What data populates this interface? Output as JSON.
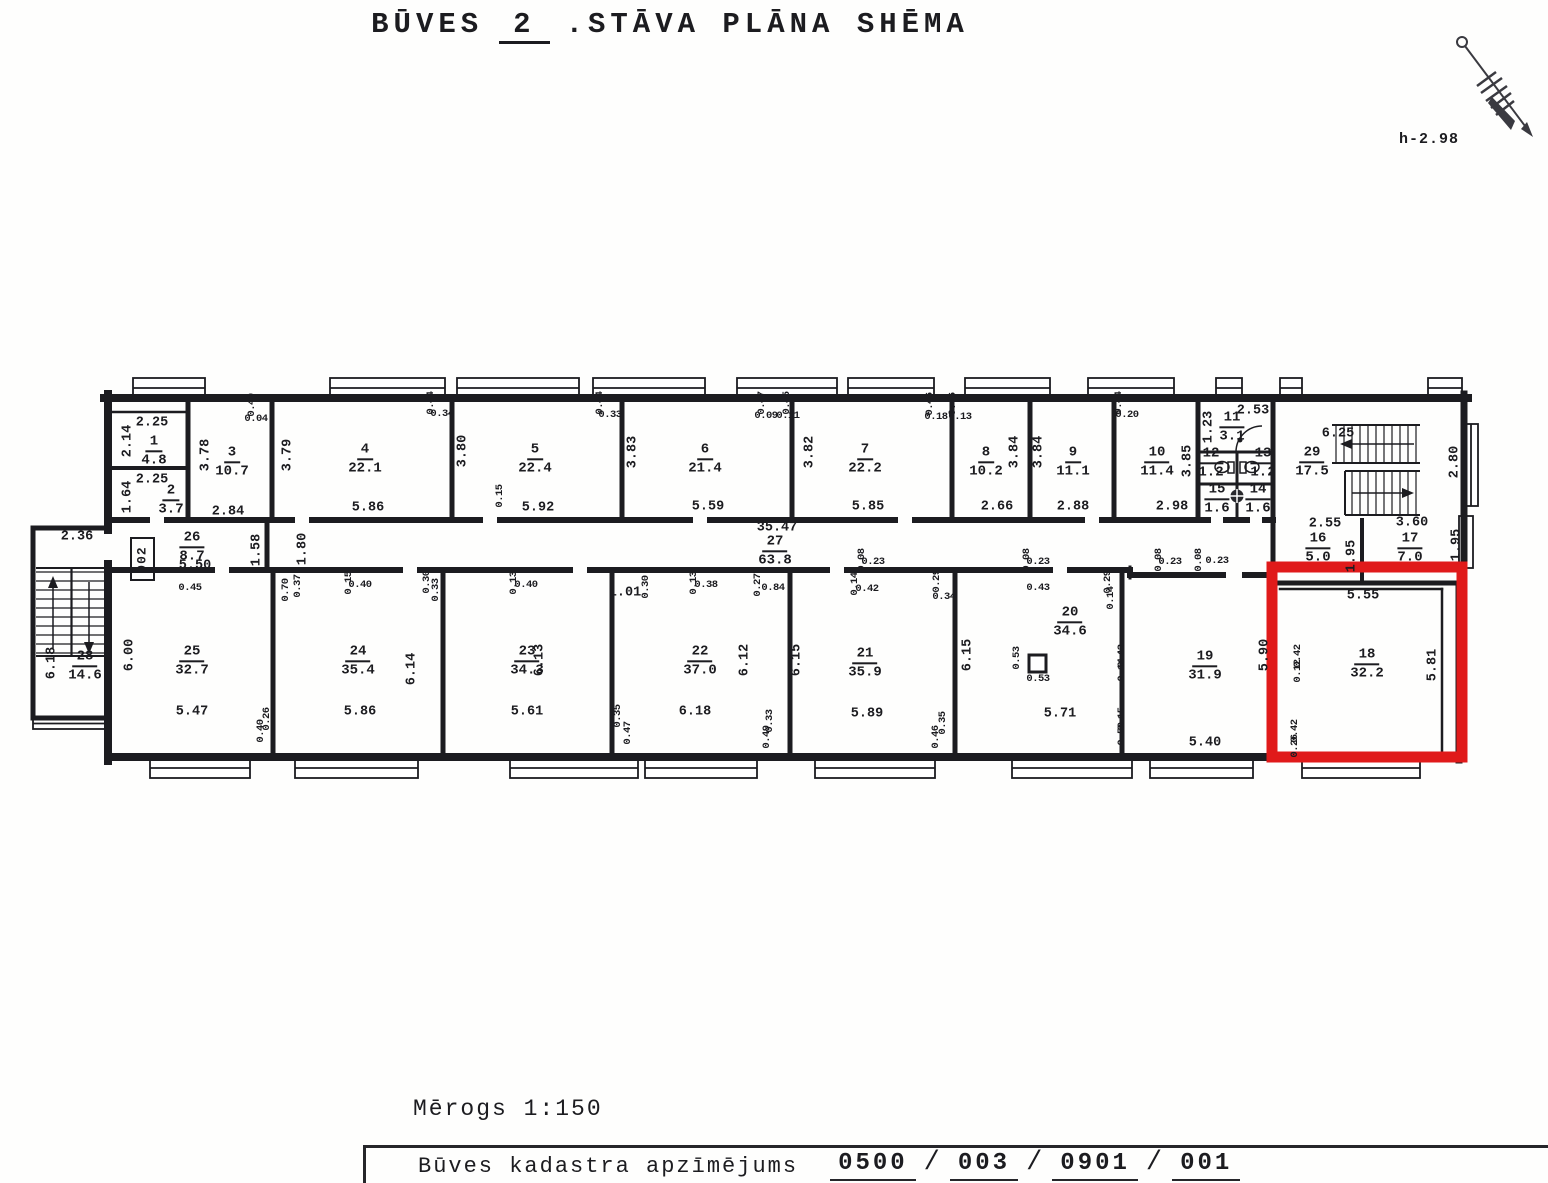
{
  "title": {
    "prefix": "BŪVES",
    "floor_num": "2",
    "suffix": ".STĀVA PLĀNA SHĒMA"
  },
  "north": {
    "height_label": "h-2.98"
  },
  "scale": {
    "label": "Mērogs 1:150"
  },
  "cadastre": {
    "label": "Būves kadastra apzīmējums",
    "separator": "/",
    "parts": [
      "0500",
      "003",
      "0901",
      "001"
    ]
  },
  "highlight": {
    "color": "#e01a1a",
    "room": "18"
  },
  "door_plate": {
    "text": "002"
  },
  "plan": {
    "rooms": [
      {
        "n": "1",
        "a": "4.8",
        "x": 154,
        "y": 451
      },
      {
        "n": "2",
        "a": "3.7",
        "x": 171,
        "y": 500
      },
      {
        "n": "3",
        "a": "10.7",
        "x": 232,
        "y": 462
      },
      {
        "n": "4",
        "a": "22.1",
        "x": 365,
        "y": 459
      },
      {
        "n": "5",
        "a": "22.4",
        "x": 535,
        "y": 459
      },
      {
        "n": "6",
        "a": "21.4",
        "x": 705,
        "y": 459
      },
      {
        "n": "7",
        "a": "22.2",
        "x": 865,
        "y": 459
      },
      {
        "n": "8",
        "a": "10.2",
        "x": 986,
        "y": 462
      },
      {
        "n": "9",
        "a": "11.1",
        "x": 1073,
        "y": 462
      },
      {
        "n": "10",
        "a": "11.4",
        "x": 1157,
        "y": 462
      },
      {
        "n": "11",
        "a": "3.1",
        "x": 1232,
        "y": 427
      },
      {
        "n": "12",
        "a": "1.2",
        "x": 1211,
        "y": 463
      },
      {
        "n": "13",
        "a": "1.2",
        "x": 1263,
        "y": 463
      },
      {
        "n": "14",
        "a": "1.6",
        "x": 1258,
        "y": 499
      },
      {
        "n": "15",
        "a": "1.6",
        "x": 1217,
        "y": 499
      },
      {
        "n": "16",
        "a": "5.0",
        "x": 1318,
        "y": 548
      },
      {
        "n": "17",
        "a": "7.0",
        "x": 1410,
        "y": 548
      },
      {
        "n": "18",
        "a": "32.2",
        "x": 1367,
        "y": 664
      },
      {
        "n": "19",
        "a": "31.9",
        "x": 1205,
        "y": 666
      },
      {
        "n": "20",
        "a": "34.6",
        "x": 1070,
        "y": 622
      },
      {
        "n": "21",
        "a": "35.9",
        "x": 865,
        "y": 663
      },
      {
        "n": "22",
        "a": "37.0",
        "x": 700,
        "y": 661
      },
      {
        "n": "23",
        "a": "34.3",
        "x": 527,
        "y": 661
      },
      {
        "n": "24",
        "a": "35.4",
        "x": 358,
        "y": 661
      },
      {
        "n": "25",
        "a": "32.7",
        "x": 192,
        "y": 661
      },
      {
        "n": "26",
        "a": "8.7",
        "x": 192,
        "y": 547
      },
      {
        "n": "27",
        "a": "63.8",
        "x": 775,
        "y": 551
      },
      {
        "n": "28",
        "a": "14.6",
        "x": 85,
        "y": 666
      },
      {
        "n": "29",
        "a": "17.5",
        "x": 1312,
        "y": 462
      }
    ],
    "dims": [
      {
        "t": "2.25",
        "x": 152,
        "y": 423
      },
      {
        "t": "2.25",
        "x": 152,
        "y": 480
      },
      {
        "t": "2.84",
        "x": 228,
        "y": 512
      },
      {
        "t": "5.86",
        "x": 368,
        "y": 508
      },
      {
        "t": "5.92",
        "x": 538,
        "y": 508
      },
      {
        "t": "5.59",
        "x": 708,
        "y": 507
      },
      {
        "t": "5.85",
        "x": 868,
        "y": 507
      },
      {
        "t": "2.66",
        "x": 997,
        "y": 507
      },
      {
        "t": "2.88",
        "x": 1073,
        "y": 507
      },
      {
        "t": "2.98",
        "x": 1172,
        "y": 507
      },
      {
        "t": "2.53",
        "x": 1253,
        "y": 411
      },
      {
        "t": "6.25",
        "x": 1338,
        "y": 434
      },
      {
        "t": "35.47",
        "x": 777,
        "y": 528
      },
      {
        "t": "2.55",
        "x": 1325,
        "y": 524
      },
      {
        "t": "3.60",
        "x": 1412,
        "y": 523
      },
      {
        "t": "5.50",
        "x": 195,
        "y": 566
      },
      {
        "t": "2.36",
        "x": 77,
        "y": 537
      },
      {
        "t": "5.47",
        "x": 192,
        "y": 712
      },
      {
        "t": "5.86",
        "x": 360,
        "y": 712
      },
      {
        "t": "5.61",
        "x": 527,
        "y": 712
      },
      {
        "t": "6.18",
        "x": 695,
        "y": 712
      },
      {
        "t": "5.89",
        "x": 867,
        "y": 714
      },
      {
        "t": "5.71",
        "x": 1060,
        "y": 714
      },
      {
        "t": "5.40",
        "x": 1205,
        "y": 743
      },
      {
        "t": "5.55",
        "x": 1363,
        "y": 596
      },
      {
        "t": "1.01",
        "x": 625,
        "y": 593
      },
      {
        "t": "0.45",
        "x": 190,
        "y": 588,
        "s": 1
      },
      {
        "t": "0.40",
        "x": 360,
        "y": 585,
        "s": 1
      },
      {
        "t": "0.40",
        "x": 526,
        "y": 585,
        "s": 1
      },
      {
        "t": "0.38",
        "x": 706,
        "y": 585,
        "s": 1
      },
      {
        "t": "0.84",
        "x": 773,
        "y": 588,
        "s": 1
      },
      {
        "t": "0.42",
        "x": 867,
        "y": 589,
        "s": 1
      },
      {
        "t": "0.34",
        "x": 944,
        "y": 597,
        "s": 1
      },
      {
        "t": "0.43",
        "x": 1038,
        "y": 588,
        "s": 1
      },
      {
        "t": "0.53",
        "x": 1038,
        "y": 679,
        "s": 1
      },
      {
        "t": "0.23",
        "x": 873,
        "y": 562,
        "s": 1
      },
      {
        "t": "0.23",
        "x": 1038,
        "y": 562,
        "s": 1
      },
      {
        "t": "0.23",
        "x": 1170,
        "y": 562,
        "s": 1
      },
      {
        "t": "0.23",
        "x": 1217,
        "y": 561,
        "s": 1
      },
      {
        "t": "0.04",
        "x": 256,
        "y": 419,
        "s": 1
      },
      {
        "t": "0.34",
        "x": 442,
        "y": 414,
        "s": 1
      },
      {
        "t": "0.33",
        "x": 610,
        "y": 415,
        "s": 1
      },
      {
        "t": "0.09",
        "x": 766,
        "y": 416,
        "s": 1
      },
      {
        "t": "0.11",
        "x": 788,
        "y": 416,
        "s": 1
      },
      {
        "t": "0.18",
        "x": 936,
        "y": 417,
        "s": 1
      },
      {
        "t": "0.13",
        "x": 960,
        "y": 417,
        "s": 1
      },
      {
        "t": "0.20",
        "x": 1127,
        "y": 415,
        "s": 1
      },
      {
        "t": "2.14",
        "x": 128,
        "y": 441,
        "r": 1
      },
      {
        "t": "1.64",
        "x": 128,
        "y": 497,
        "r": 1
      },
      {
        "t": "3.78",
        "x": 206,
        "y": 455,
        "r": 1
      },
      {
        "t": "3.79",
        "x": 288,
        "y": 455,
        "r": 1
      },
      {
        "t": "3.80",
        "x": 463,
        "y": 451,
        "r": 1
      },
      {
        "t": "3.83",
        "x": 633,
        "y": 452,
        "r": 1
      },
      {
        "t": "3.82",
        "x": 810,
        "y": 452,
        "r": 1
      },
      {
        "t": "3.84",
        "x": 1015,
        "y": 452,
        "r": 1
      },
      {
        "t": "3.84",
        "x": 1039,
        "y": 452,
        "r": 1
      },
      {
        "t": "3.85",
        "x": 1188,
        "y": 461,
        "r": 1
      },
      {
        "t": "1.23",
        "x": 1209,
        "y": 427,
        "r": 1
      },
      {
        "t": "0.15",
        "x": 500,
        "y": 496,
        "r": 1,
        "s": 1
      },
      {
        "t": "2.80",
        "x": 1455,
        "y": 462,
        "r": 1
      },
      {
        "t": "1.95",
        "x": 1352,
        "y": 556,
        "r": 1
      },
      {
        "t": "1.95",
        "x": 1457,
        "y": 545,
        "r": 1
      },
      {
        "t": "1.58",
        "x": 257,
        "y": 550,
        "r": 1
      },
      {
        "t": "1.80",
        "x": 303,
        "y": 549,
        "r": 1
      },
      {
        "t": "6.18",
        "x": 52,
        "y": 663,
        "r": 1
      },
      {
        "t": "6.00",
        "x": 130,
        "y": 655,
        "r": 1
      },
      {
        "t": "6.14",
        "x": 412,
        "y": 669,
        "r": 1
      },
      {
        "t": "6.13",
        "x": 540,
        "y": 660,
        "r": 1
      },
      {
        "t": "6.12",
        "x": 745,
        "y": 660,
        "r": 1
      },
      {
        "t": "6.15",
        "x": 797,
        "y": 660,
        "r": 1
      },
      {
        "t": "6.15",
        "x": 968,
        "y": 655,
        "r": 1
      },
      {
        "t": "5.90",
        "x": 1265,
        "y": 655,
        "r": 1
      },
      {
        "t": "5.81",
        "x": 1433,
        "y": 665,
        "r": 1
      },
      {
        "t": "0.40",
        "x": 252,
        "y": 405,
        "r": 1,
        "s": 1
      },
      {
        "t": "0.44",
        "x": 431,
        "y": 403,
        "r": 1,
        "s": 1
      },
      {
        "t": "0.44",
        "x": 600,
        "y": 403,
        "r": 1,
        "s": 1
      },
      {
        "t": "0.47",
        "x": 762,
        "y": 403,
        "r": 1,
        "s": 1
      },
      {
        "t": "0.45",
        "x": 787,
        "y": 403,
        "r": 1,
        "s": 1
      },
      {
        "t": "0.46",
        "x": 930,
        "y": 404,
        "r": 1,
        "s": 1
      },
      {
        "t": "0.46",
        "x": 953,
        "y": 404,
        "r": 1,
        "s": 1
      },
      {
        "t": "0.44",
        "x": 1119,
        "y": 403,
        "r": 1,
        "s": 1
      },
      {
        "t": "0.70",
        "x": 286,
        "y": 590,
        "r": 1,
        "s": 1
      },
      {
        "t": "0.37",
        "x": 298,
        "y": 586,
        "r": 1,
        "s": 1
      },
      {
        "t": "0.15",
        "x": 349,
        "y": 583,
        "r": 1,
        "s": 1
      },
      {
        "t": "0.30",
        "x": 427,
        "y": 582,
        "r": 1,
        "s": 1
      },
      {
        "t": "0.33",
        "x": 436,
        "y": 590,
        "r": 1,
        "s": 1
      },
      {
        "t": "0.13",
        "x": 514,
        "y": 583,
        "r": 1,
        "s": 1
      },
      {
        "t": "0.30",
        "x": 646,
        "y": 587,
        "r": 1,
        "s": 1
      },
      {
        "t": "0.13",
        "x": 694,
        "y": 583,
        "r": 1,
        "s": 1
      },
      {
        "t": "0.27",
        "x": 758,
        "y": 585,
        "r": 1,
        "s": 1
      },
      {
        "t": "0.14",
        "x": 855,
        "y": 584,
        "r": 1,
        "s": 1
      },
      {
        "t": "0.29",
        "x": 937,
        "y": 581,
        "r": 1,
        "s": 1
      },
      {
        "t": "0.08",
        "x": 862,
        "y": 560,
        "r": 1,
        "s": 1
      },
      {
        "t": "0.08",
        "x": 1027,
        "y": 560,
        "r": 1,
        "s": 1
      },
      {
        "t": "0.08",
        "x": 1159,
        "y": 560,
        "r": 1,
        "s": 1
      },
      {
        "t": "0.08",
        "x": 1199,
        "y": 560,
        "r": 1,
        "s": 1
      },
      {
        "t": "0.29",
        "x": 1108,
        "y": 582,
        "r": 1,
        "s": 1
      },
      {
        "t": "0.14",
        "x": 1111,
        "y": 598,
        "r": 1,
        "s": 1
      },
      {
        "t": "0.43",
        "x": 1122,
        "y": 656,
        "r": 1,
        "s": 1
      },
      {
        "t": "0.14",
        "x": 1122,
        "y": 670,
        "r": 1,
        "s": 1
      },
      {
        "t": "0.15",
        "x": 1122,
        "y": 719,
        "r": 1,
        "s": 1
      },
      {
        "t": "0.50",
        "x": 1122,
        "y": 734,
        "r": 1,
        "s": 1
      },
      {
        "t": "0.53",
        "x": 1017,
        "y": 658,
        "r": 1,
        "s": 1
      },
      {
        "t": "0.26",
        "x": 267,
        "y": 719,
        "r": 1,
        "s": 1
      },
      {
        "t": "0.40",
        "x": 261,
        "y": 731,
        "r": 1,
        "s": 1
      },
      {
        "t": "0.35",
        "x": 618,
        "y": 716,
        "r": 1,
        "s": 1
      },
      {
        "t": "0.47",
        "x": 628,
        "y": 733,
        "r": 1,
        "s": 1
      },
      {
        "t": "0.33",
        "x": 770,
        "y": 721,
        "r": 1,
        "s": 1
      },
      {
        "t": "0.49",
        "x": 767,
        "y": 737,
        "r": 1,
        "s": 1
      },
      {
        "t": "0.35",
        "x": 943,
        "y": 723,
        "r": 1,
        "s": 1
      },
      {
        "t": "0.46",
        "x": 936,
        "y": 737,
        "r": 1,
        "s": 1
      },
      {
        "t": "0.42",
        "x": 1298,
        "y": 656,
        "r": 1,
        "s": 1
      },
      {
        "t": "0.12",
        "x": 1298,
        "y": 671,
        "r": 1,
        "s": 1
      },
      {
        "t": "0.42",
        "x": 1295,
        "y": 731,
        "r": 1,
        "s": 1
      },
      {
        "t": "0.26",
        "x": 1295,
        "y": 746,
        "r": 1,
        "s": 1
      }
    ]
  }
}
